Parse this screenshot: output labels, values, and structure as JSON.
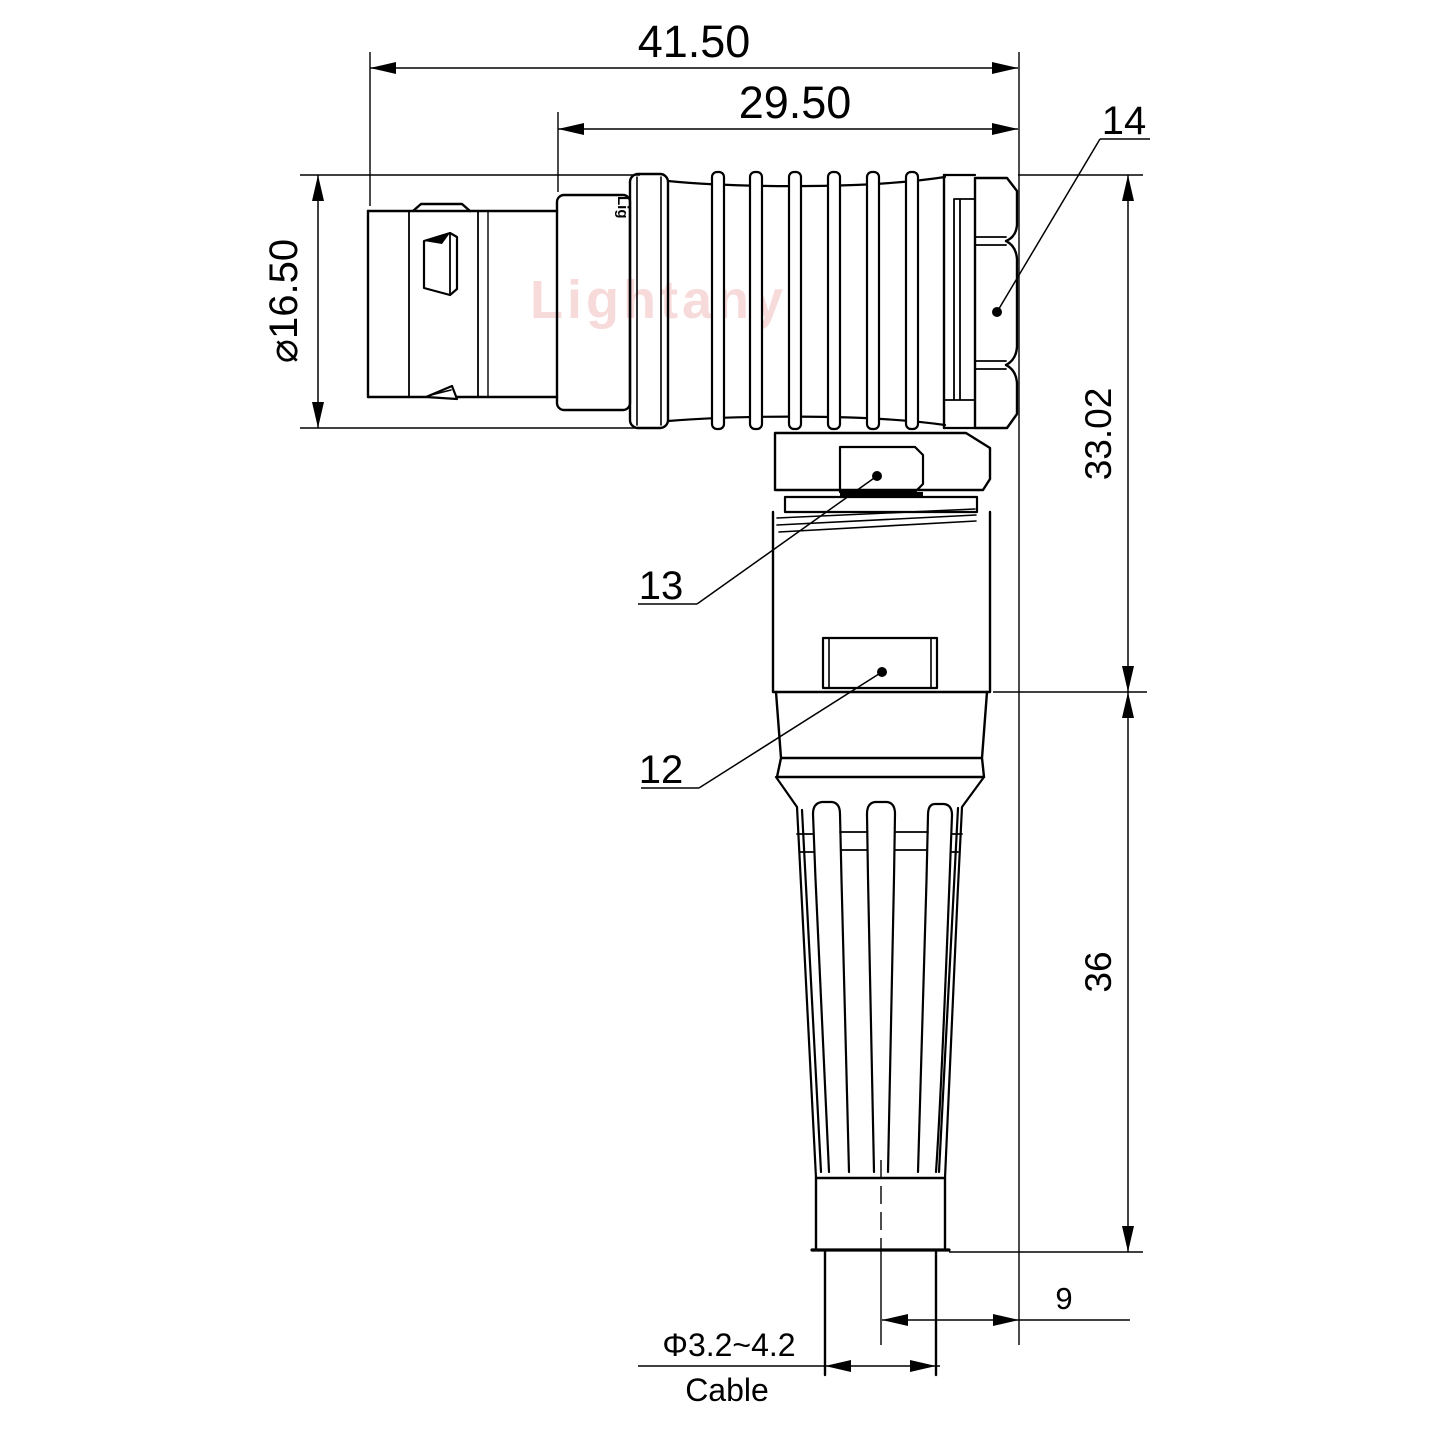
{
  "drawing": {
    "watermark": "Lightany",
    "brand_mark": "Lig",
    "colors": {
      "line": "#000000",
      "watermark_pink": "#f2bcbc"
    },
    "dimensions": {
      "overall_length": "41.50",
      "coupling_length": "29.50",
      "front_diameter": "⌀16.50",
      "elbow_height": "33.02",
      "boot_length": "36",
      "cable_offset": "9",
      "cable_diameter": "Φ3.2~4.2",
      "cable_label": "Cable"
    },
    "callouts": {
      "hex_nut": "14",
      "back_nut": "13",
      "body": "12"
    }
  }
}
